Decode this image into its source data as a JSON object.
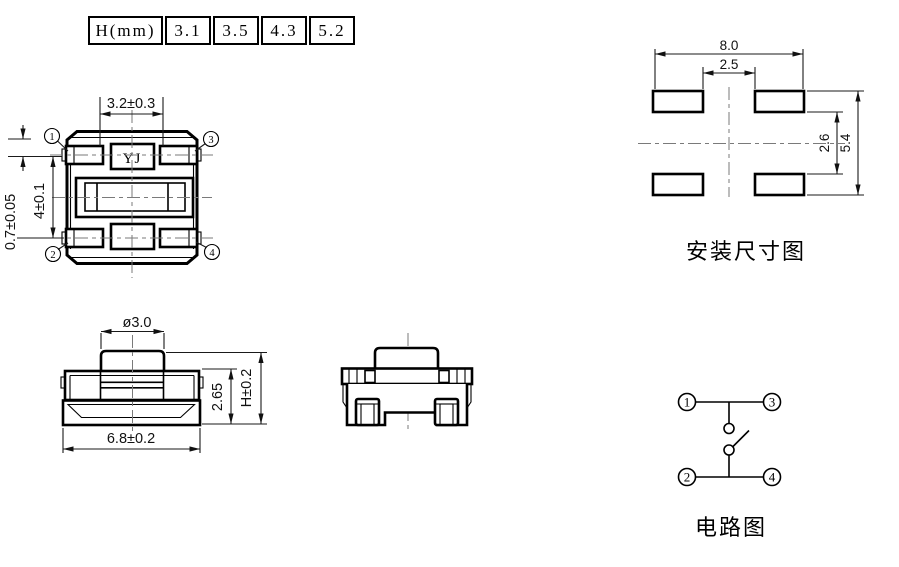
{
  "table": {
    "header": "H(mm)",
    "col1": "3.1",
    "col2": "3.5",
    "col3": "4.3",
    "col4": "5.2"
  },
  "top_view": {
    "marking": "YJ",
    "dim_top_width": "3.2±0.3",
    "dim_row_pitch": "4±0.1",
    "dim_pad_height": "0.7±0.05",
    "pin_top_left": "1",
    "pin_top_right": "3",
    "pin_bottom_left": "2",
    "pin_bottom_right": "4"
  },
  "front_view": {
    "dim_stem_diameter": "ø3.0",
    "dim_body_width": "6.8±0.2",
    "dim_body_height": "2.65",
    "dim_total_height": "H±0.2"
  },
  "mounting_view": {
    "title": "安装尺寸图",
    "dim_outer_width": "8.0",
    "dim_pad_gap_width": "2.5",
    "dim_pad_gap_height": "2.6",
    "dim_outer_height": "5.4"
  },
  "circuit": {
    "title": "电路图",
    "pin1": "1",
    "pin2": "2",
    "pin3": "3",
    "pin4": "4"
  }
}
